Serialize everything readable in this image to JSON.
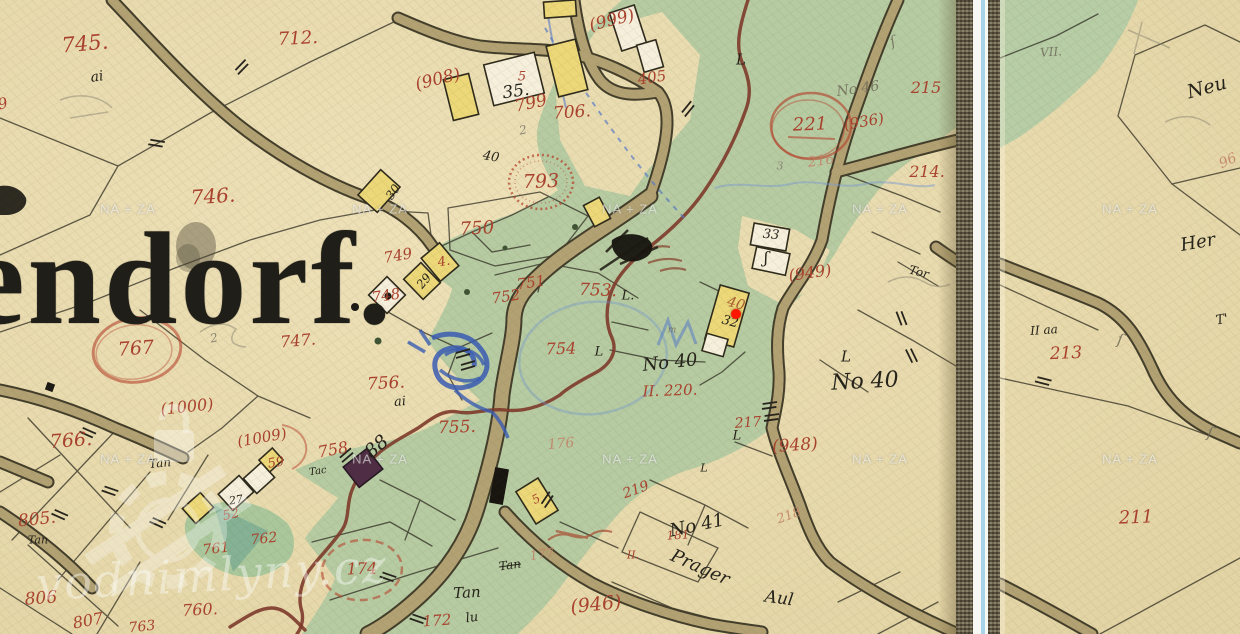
{
  "map": {
    "village_name_fragment": "endorf.",
    "marker": {
      "x": 736,
      "y": 314,
      "color": "#ff1500"
    },
    "watermark": {
      "tile_text": "NA + ZA",
      "brand_text": "vodnimlyny.cz"
    },
    "divider_color": "#a8d4ea",
    "labels": [
      {
        "t": "745.",
        "x": 85,
        "y": 44,
        "s": 21,
        "r": -5,
        "c": "r"
      },
      {
        "t": "712.",
        "x": 298,
        "y": 39,
        "s": 18,
        "r": -3,
        "c": "r"
      },
      {
        "t": "(908)",
        "x": 438,
        "y": 80,
        "s": 17,
        "r": -14,
        "c": "r"
      },
      {
        "t": "(999)",
        "x": 612,
        "y": 21,
        "s": 17,
        "r": -14,
        "c": "r"
      },
      {
        "t": "405",
        "x": 652,
        "y": 78,
        "s": 15,
        "r": -8,
        "c": "r"
      },
      {
        "t": "799",
        "x": 531,
        "y": 104,
        "s": 17,
        "r": -12,
        "c": "r"
      },
      {
        "t": "706.",
        "x": 572,
        "y": 113,
        "s": 17,
        "r": -4,
        "c": "r"
      },
      {
        "t": "215",
        "x": 926,
        "y": 88,
        "s": 16,
        "r": 0,
        "c": "r"
      },
      {
        "t": "(936)",
        "x": 864,
        "y": 122,
        "s": 15,
        "r": -10,
        "c": "r"
      },
      {
        "t": "221",
        "x": 810,
        "y": 125,
        "s": 18,
        "r": -2,
        "c": "r"
      },
      {
        "t": "216",
        "x": 821,
        "y": 161,
        "s": 14,
        "r": -8,
        "c": "f"
      },
      {
        "t": "214.",
        "x": 927,
        "y": 172,
        "s": 16,
        "r": 0,
        "c": "r"
      },
      {
        "t": "746.",
        "x": 213,
        "y": 196,
        "s": 20,
        "r": -4,
        "c": "r"
      },
      {
        "t": "793",
        "x": 541,
        "y": 182,
        "s": 19,
        "r": -2,
        "c": "r"
      },
      {
        "t": "750",
        "x": 477,
        "y": 229,
        "s": 18,
        "r": -3,
        "c": "r"
      },
      {
        "t": "749",
        "x": 398,
        "y": 256,
        "s": 15,
        "r": -10,
        "c": "r"
      },
      {
        "t": "748",
        "x": 386,
        "y": 296,
        "s": 15,
        "r": -8,
        "c": "r"
      },
      {
        "t": "747.",
        "x": 298,
        "y": 341,
        "s": 16,
        "r": -5,
        "c": "r"
      },
      {
        "t": "767",
        "x": 136,
        "y": 349,
        "s": 19,
        "r": -4,
        "c": "r"
      },
      {
        "t": "751",
        "x": 531,
        "y": 283,
        "s": 15,
        "r": -8,
        "c": "r"
      },
      {
        "t": "752",
        "x": 506,
        "y": 297,
        "s": 15,
        "r": -8,
        "c": "r"
      },
      {
        "t": "753.",
        "x": 598,
        "y": 291,
        "s": 17,
        "r": 2,
        "c": "r"
      },
      {
        "t": "754",
        "x": 561,
        "y": 349,
        "s": 16,
        "r": -2,
        "c": "r"
      },
      {
        "t": "756.",
        "x": 386,
        "y": 384,
        "s": 17,
        "r": -3,
        "c": "r"
      },
      {
        "t": "755.",
        "x": 457,
        "y": 428,
        "s": 17,
        "r": -2,
        "c": "r"
      },
      {
        "t": "176",
        "x": 561,
        "y": 444,
        "s": 14,
        "r": -5,
        "c": "f"
      },
      {
        "t": "758",
        "x": 333,
        "y": 450,
        "s": 16,
        "r": -10,
        "c": "r"
      },
      {
        "t": "(1000)",
        "x": 187,
        "y": 407,
        "s": 16,
        "r": -6,
        "c": "r"
      },
      {
        "t": "(1009)",
        "x": 262,
        "y": 438,
        "s": 15,
        "r": -10,
        "c": "r"
      },
      {
        "t": "766.",
        "x": 71,
        "y": 441,
        "s": 19,
        "r": -4,
        "c": "r"
      },
      {
        "t": "805.",
        "x": 37,
        "y": 520,
        "s": 17,
        "r": -6,
        "c": "r"
      },
      {
        "t": "806",
        "x": 41,
        "y": 599,
        "s": 17,
        "r": -4,
        "c": "r"
      },
      {
        "t": "807",
        "x": 88,
        "y": 621,
        "s": 16,
        "r": -10,
        "c": "r"
      },
      {
        "t": "763",
        "x": 142,
        "y": 627,
        "s": 14,
        "r": -6,
        "c": "r"
      },
      {
        "t": "760.",
        "x": 200,
        "y": 610,
        "s": 16,
        "r": -3,
        "c": "r"
      },
      {
        "t": "761",
        "x": 216,
        "y": 549,
        "s": 14,
        "r": -6,
        "c": "r"
      },
      {
        "t": "762",
        "x": 264,
        "y": 539,
        "s": 14,
        "r": -6,
        "c": "r"
      },
      {
        "t": "52",
        "x": 231,
        "y": 515,
        "s": 13,
        "r": -12,
        "c": "r"
      },
      {
        "t": "59",
        "x": 276,
        "y": 463,
        "s": 13,
        "r": -10,
        "c": "r"
      },
      {
        "t": "174",
        "x": 362,
        "y": 569,
        "s": 16,
        "r": -2,
        "c": "r"
      },
      {
        "t": "172",
        "x": 437,
        "y": 621,
        "s": 15,
        "r": -4,
        "c": "r"
      },
      {
        "t": "(946)",
        "x": 596,
        "y": 605,
        "s": 19,
        "r": -6,
        "c": "r"
      },
      {
        "t": "219",
        "x": 636,
        "y": 490,
        "s": 14,
        "r": -20,
        "c": "r"
      },
      {
        "t": "218",
        "x": 789,
        "y": 516,
        "s": 13,
        "r": -20,
        "c": "f"
      },
      {
        "t": "181",
        "x": 678,
        "y": 535,
        "s": 12,
        "r": -3,
        "c": "r"
      },
      {
        "t": "II.",
        "x": 633,
        "y": 555,
        "s": 11,
        "r": 0,
        "c": "r"
      },
      {
        "t": "II. 220.",
        "x": 670,
        "y": 391,
        "s": 15,
        "r": -2,
        "c": "r"
      },
      {
        "t": "217",
        "x": 748,
        "y": 423,
        "s": 14,
        "r": -4,
        "c": "r"
      },
      {
        "t": "(948)",
        "x": 795,
        "y": 446,
        "s": 17,
        "r": -4,
        "c": "r"
      },
      {
        "t": "(949)",
        "x": 810,
        "y": 273,
        "s": 16,
        "r": -8,
        "c": "r"
      },
      {
        "t": "177",
        "x": 542,
        "y": 555,
        "s": 13,
        "r": -8,
        "c": "f"
      },
      {
        "t": "5",
        "x": 522,
        "y": 77,
        "s": 13,
        "r": 0,
        "c": "r"
      },
      {
        "t": "4.",
        "x": 444,
        "y": 262,
        "s": 13,
        "r": -10,
        "c": "r"
      },
      {
        "t": "40",
        "x": 736,
        "y": 304,
        "s": 14,
        "r": 15,
        "c": "b"
      },
      {
        "t": "5",
        "x": 536,
        "y": 499,
        "s": 12,
        "r": -30,
        "c": "r"
      },
      {
        "t": "213",
        "x": 1066,
        "y": 354,
        "s": 17,
        "r": -2,
        "c": "r"
      },
      {
        "t": "211",
        "x": 1136,
        "y": 518,
        "s": 18,
        "r": -2,
        "c": "r"
      },
      {
        "t": "96",
        "x": 1228,
        "y": 161,
        "s": 14,
        "r": -25,
        "c": "f"
      },
      {
        "t": "9",
        "x": 3,
        "y": 104,
        "s": 15,
        "r": -15,
        "c": "r"
      },
      {
        "t": "ai",
        "x": 97,
        "y": 77,
        "s": 14,
        "r": -8,
        "c": "k"
      },
      {
        "t": "ai",
        "x": 400,
        "y": 402,
        "s": 13,
        "r": -5,
        "c": "k"
      },
      {
        "t": "35.",
        "x": 516,
        "y": 92,
        "s": 17,
        "r": -8,
        "c": "k"
      },
      {
        "t": "30",
        "x": 393,
        "y": 192,
        "s": 12,
        "r": -55,
        "c": "k"
      },
      {
        "t": "29",
        "x": 424,
        "y": 281,
        "s": 12,
        "r": -50,
        "c": "k"
      },
      {
        "t": "33",
        "x": 771,
        "y": 235,
        "s": 13,
        "r": 5,
        "c": "k"
      },
      {
        "t": "32",
        "x": 730,
        "y": 322,
        "s": 13,
        "r": 15,
        "c": "k"
      },
      {
        "t": "40",
        "x": 491,
        "y": 157,
        "s": 13,
        "r": 10,
        "c": "k"
      },
      {
        "t": "88",
        "x": 377,
        "y": 447,
        "s": 19,
        "r": -40,
        "c": "k"
      },
      {
        "t": "27",
        "x": 236,
        "y": 500,
        "s": 11,
        "r": -10,
        "c": "k"
      },
      {
        "t": "No 40",
        "x": 670,
        "y": 363,
        "s": 18,
        "r": -6,
        "c": "k"
      },
      {
        "t": "No 40",
        "x": 865,
        "y": 382,
        "s": 22,
        "r": -3,
        "c": "k"
      },
      {
        "t": "No 46",
        "x": 858,
        "y": 89,
        "s": 14,
        "r": -8,
        "c": "g"
      },
      {
        "t": "No 41",
        "x": 697,
        "y": 526,
        "s": 18,
        "r": -12,
        "c": "k"
      },
      {
        "t": "Prager",
        "x": 700,
        "y": 568,
        "s": 18,
        "r": 24,
        "c": "k"
      },
      {
        "t": "Aul",
        "x": 779,
        "y": 599,
        "s": 17,
        "r": 8,
        "c": "k"
      },
      {
        "t": "Tan",
        "x": 160,
        "y": 463,
        "s": 12,
        "r": -5,
        "c": "k"
      },
      {
        "t": "Tan",
        "x": 38,
        "y": 540,
        "s": 11,
        "r": 0,
        "c": "k"
      },
      {
        "t": "Tac",
        "x": 318,
        "y": 472,
        "s": 10,
        "r": -8,
        "c": "k"
      },
      {
        "t": "Tan",
        "x": 510,
        "y": 565,
        "s": 12,
        "r": -8,
        "c": "k",
        "st": 1
      },
      {
        "t": "Tan",
        "x": 467,
        "y": 593,
        "s": 15,
        "r": -3,
        "c": "k"
      },
      {
        "t": "Tor",
        "x": 919,
        "y": 272,
        "s": 12,
        "r": 15,
        "c": "k"
      },
      {
        "t": "ʃ",
        "x": 766,
        "y": 258,
        "s": 16,
        "r": 0,
        "c": "k"
      },
      {
        "t": "L",
        "x": 741,
        "y": 60,
        "s": 15,
        "r": 0,
        "c": "k"
      },
      {
        "t": "L.",
        "x": 628,
        "y": 296,
        "s": 13,
        "r": 0,
        "c": "k"
      },
      {
        "t": "L",
        "x": 599,
        "y": 352,
        "s": 13,
        "r": 0,
        "c": "k"
      },
      {
        "t": "L",
        "x": 846,
        "y": 357,
        "s": 15,
        "r": 0,
        "c": "k"
      },
      {
        "t": "L",
        "x": 737,
        "y": 436,
        "s": 13,
        "r": 0,
        "c": "k"
      },
      {
        "t": "L",
        "x": 704,
        "y": 468,
        "s": 11,
        "r": 0,
        "c": "k"
      },
      {
        "t": "VII.",
        "x": 1051,
        "y": 52,
        "s": 12,
        "r": -4,
        "c": "g"
      },
      {
        "t": "Neu",
        "x": 1207,
        "y": 88,
        "s": 19,
        "r": -15,
        "c": "k"
      },
      {
        "t": "Her",
        "x": 1198,
        "y": 243,
        "s": 18,
        "r": -10,
        "c": "k"
      },
      {
        "t": "II aa",
        "x": 1044,
        "y": 330,
        "s": 12,
        "r": -4,
        "c": "k"
      },
      {
        "t": "T'",
        "x": 1222,
        "y": 320,
        "s": 13,
        "r": -10,
        "c": "k"
      },
      {
        "t": "lu",
        "x": 472,
        "y": 618,
        "s": 13,
        "r": -8,
        "c": "k"
      },
      {
        "t": "2",
        "x": 523,
        "y": 130,
        "s": 12,
        "r": -10,
        "c": "p"
      },
      {
        "t": "3",
        "x": 780,
        "y": 166,
        "s": 11,
        "r": 0,
        "c": "p"
      },
      {
        "t": "2",
        "x": 214,
        "y": 338,
        "s": 12,
        "r": -10,
        "c": "p"
      },
      {
        "t": "ſ",
        "x": 1120,
        "y": 340,
        "s": 15,
        "r": 10,
        "c": "g"
      },
      {
        "t": "ſ",
        "x": 1210,
        "y": 433,
        "s": 15,
        "r": 10,
        "c": "g"
      },
      {
        "t": "ſ",
        "x": 893,
        "y": 42,
        "s": 14,
        "r": -20,
        "c": "g"
      },
      {
        "t": "m",
        "x": 672,
        "y": 331,
        "s": 9,
        "r": 0,
        "c": "g"
      }
    ]
  }
}
